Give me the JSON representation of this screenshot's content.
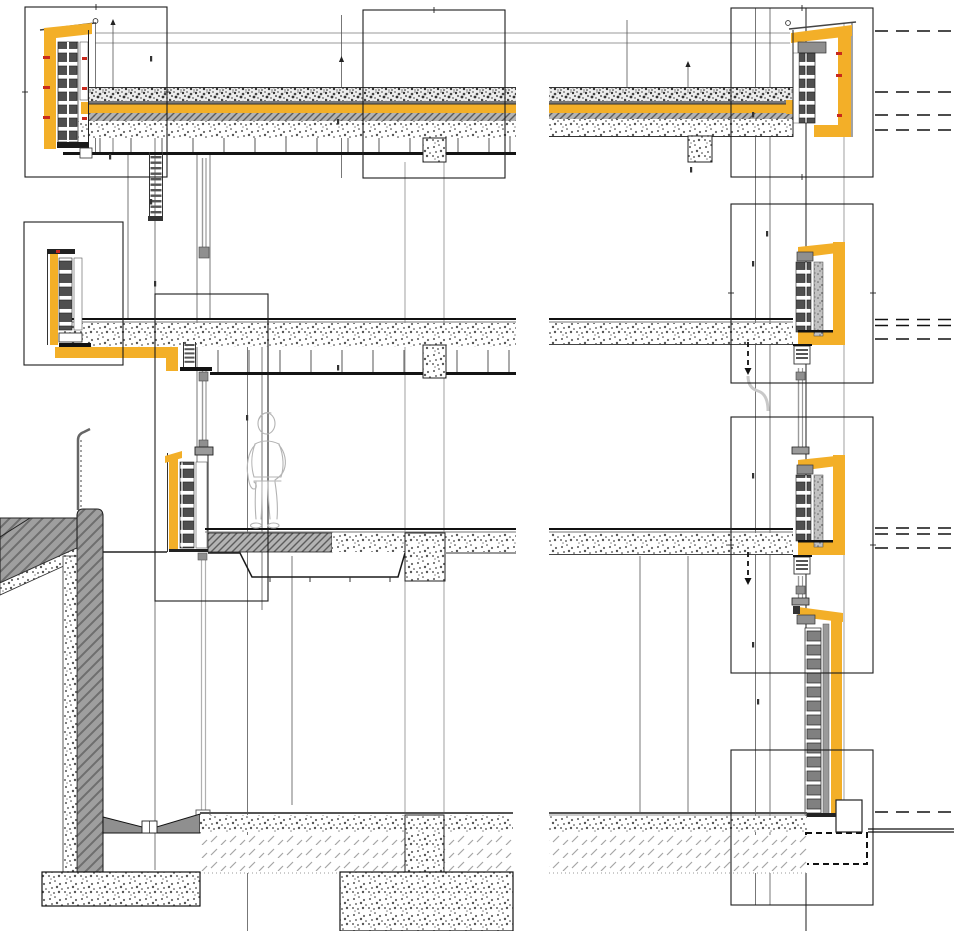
{
  "drawing": {
    "type": "architectural-cross-section-detail",
    "sheet": "facade-and-slab-junction-details",
    "left_column_details": [
      "roof-parapet-detail",
      "upper-floor-slab-edge-detail",
      "setback-spandrel-wall-detail",
      "basement-retaining-wall",
      "strip-footing-and-pad-footing"
    ],
    "right_column_details": [
      "roof-parapet-detail",
      "floor-slab-edge-detail-upper",
      "floor-slab-edge-detail-lower",
      "ground-floor-plinth-detail"
    ],
    "callout_box_count": 8,
    "scale_figure": "standing-person-outline",
    "match_lines": "dashed-lines-at-right-edge"
  },
  "colors": {
    "paper": "#ffffff",
    "line": "#1c1c1c",
    "ceiling": "#141414",
    "insulation": "#F3AF28",
    "fastener": "#C8291C",
    "gravel_bg": "#ededed",
    "screed_bg": "#b3b3b3",
    "screed_line": "#5c5c5c",
    "wall_bg": "#9f9f9f",
    "wall_line": "#6e6e6e",
    "block_dark": "#4f4f4f",
    "block_mid": "#808080",
    "speckle_bg": "#c2c2c2",
    "subbase_line": "#a5a5a5",
    "drain": "#8f8f8f",
    "pipe": "#b0b0b0",
    "figure": "#b3b3b3",
    "gray_fitting": "#8f8f8f"
  }
}
